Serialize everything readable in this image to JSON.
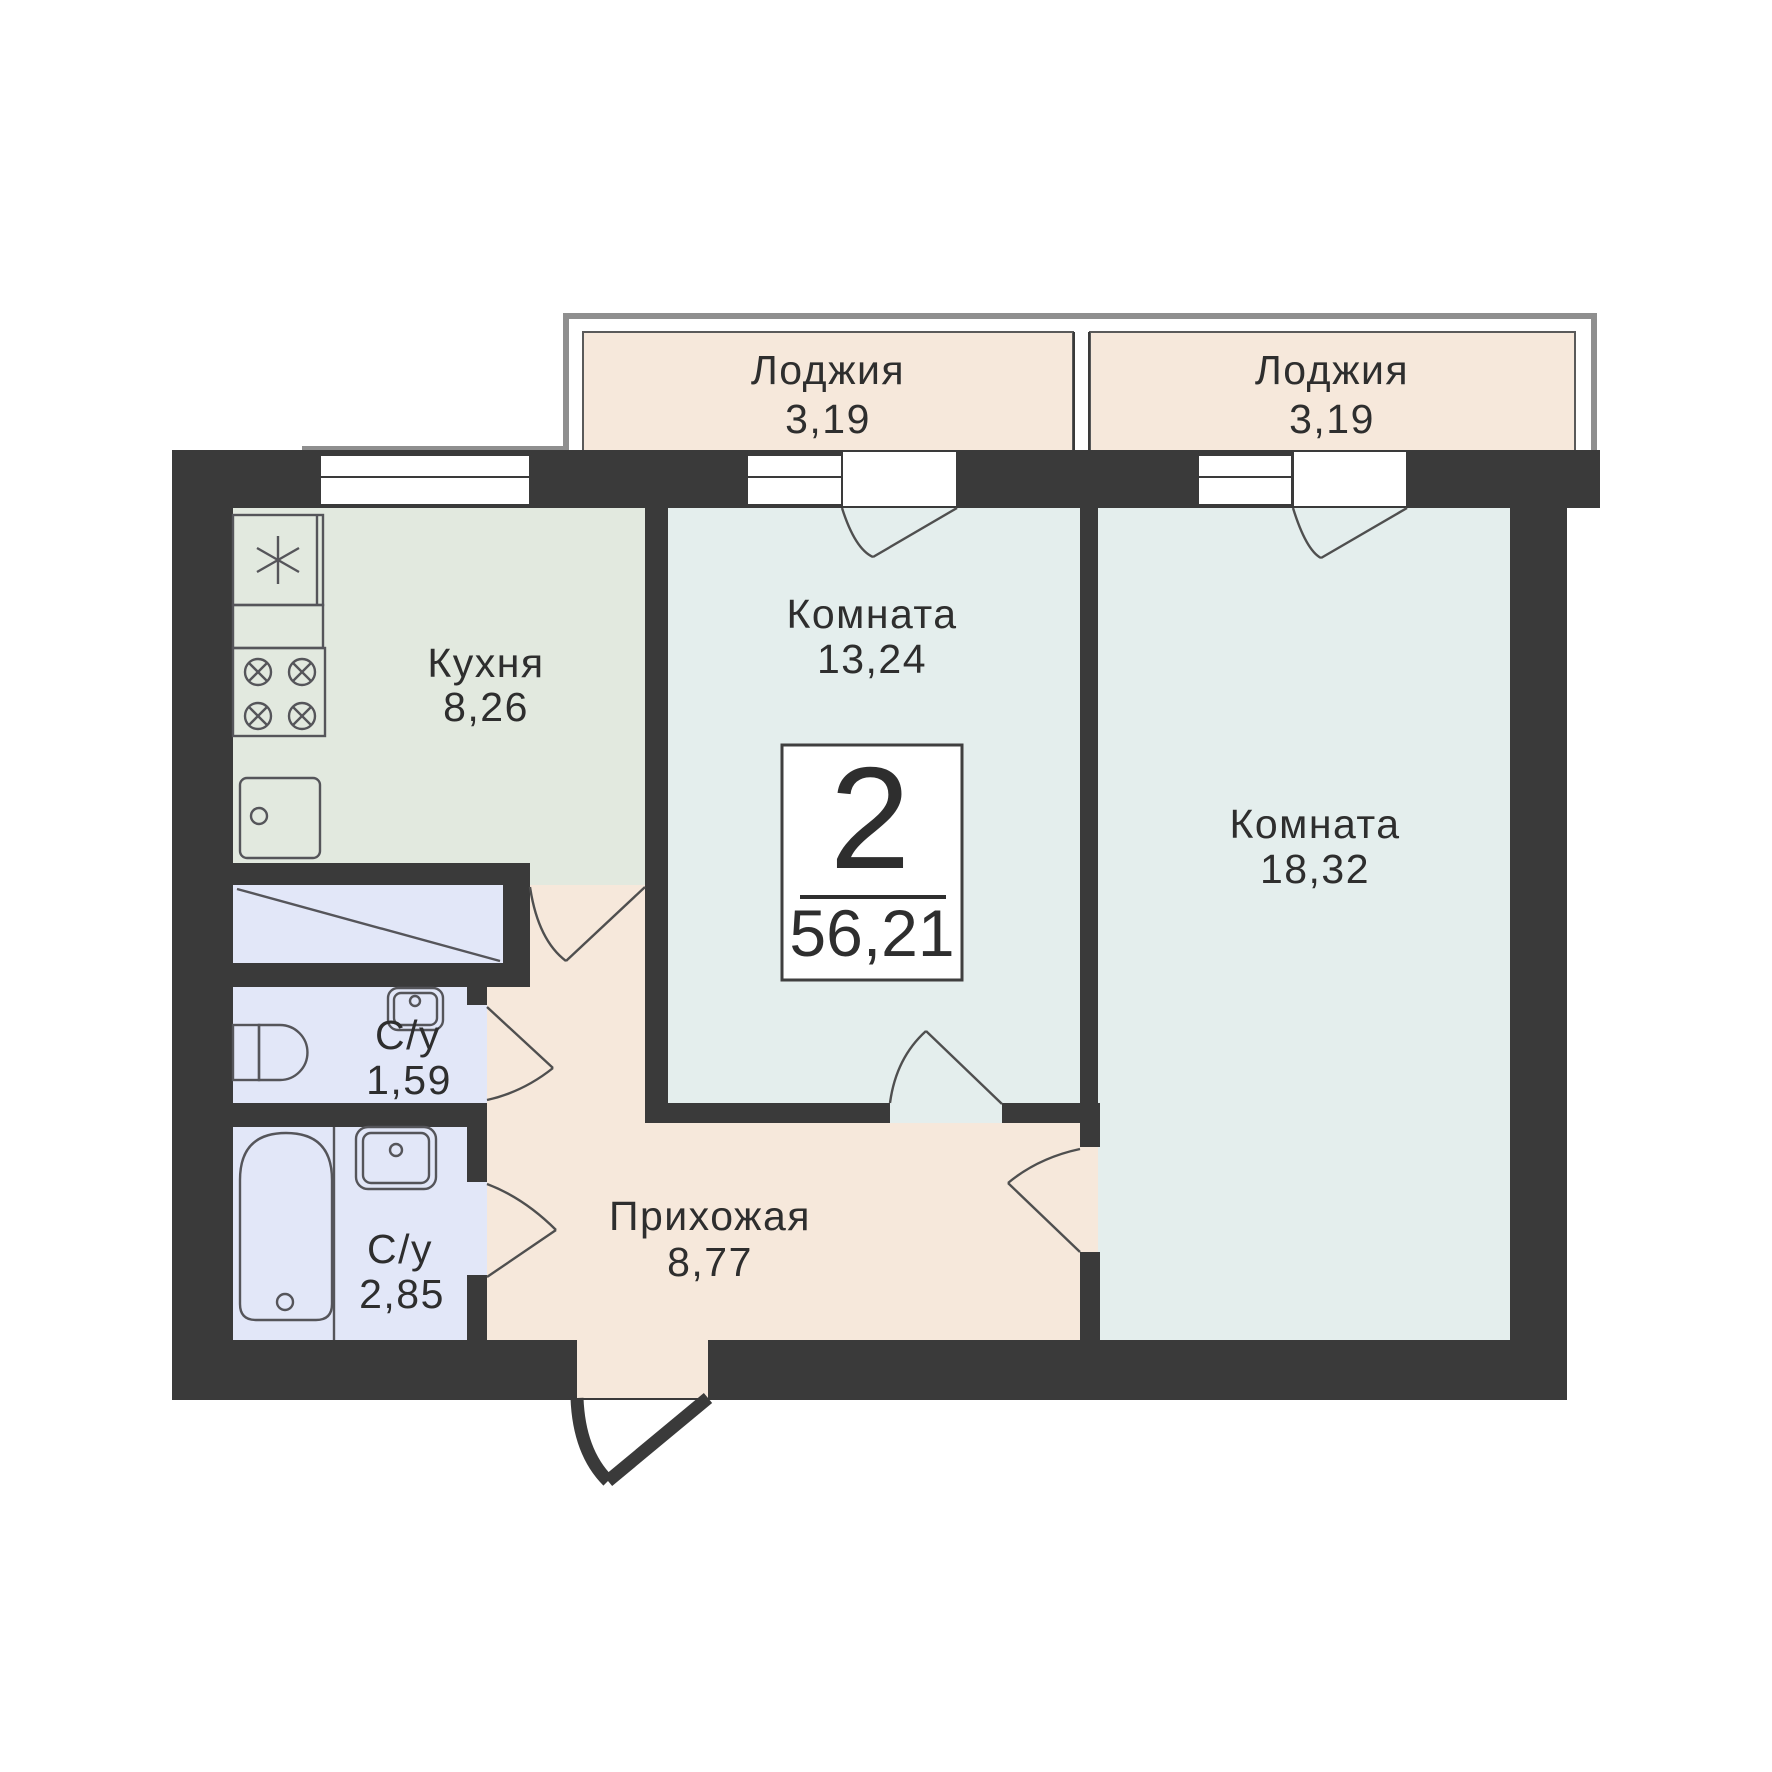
{
  "badge": {
    "room_count": "2",
    "total_area": "56,21"
  },
  "rooms": {
    "loggia_left": {
      "name": "Лоджия",
      "area": "3,19"
    },
    "loggia_right": {
      "name": "Лоджия",
      "area": "3,19"
    },
    "kitchen": {
      "name": "Кухня",
      "area": "8,26"
    },
    "room_1": {
      "name": "Комната",
      "area": "13,24"
    },
    "room_2": {
      "name": "Комната",
      "area": "18,32"
    },
    "bathroom_1": {
      "name": "С/у",
      "area": "1,59"
    },
    "bathroom_2": {
      "name": "С/у",
      "area": "2,85"
    },
    "hallway": {
      "name": "Прихожая",
      "area": "8,77"
    }
  },
  "colors": {
    "background": "#ffffff",
    "wall": "#3a3a3a",
    "living_room_fill": "#e4eeed",
    "kitchen_fill": "#e2e9df",
    "wet_room_fill": "#e2e7f8",
    "warm_fill": "#f6e8db",
    "slab_outline": "#8f8f8f",
    "fixture_stroke": "#55555a",
    "text": "#2e2e2e"
  }
}
